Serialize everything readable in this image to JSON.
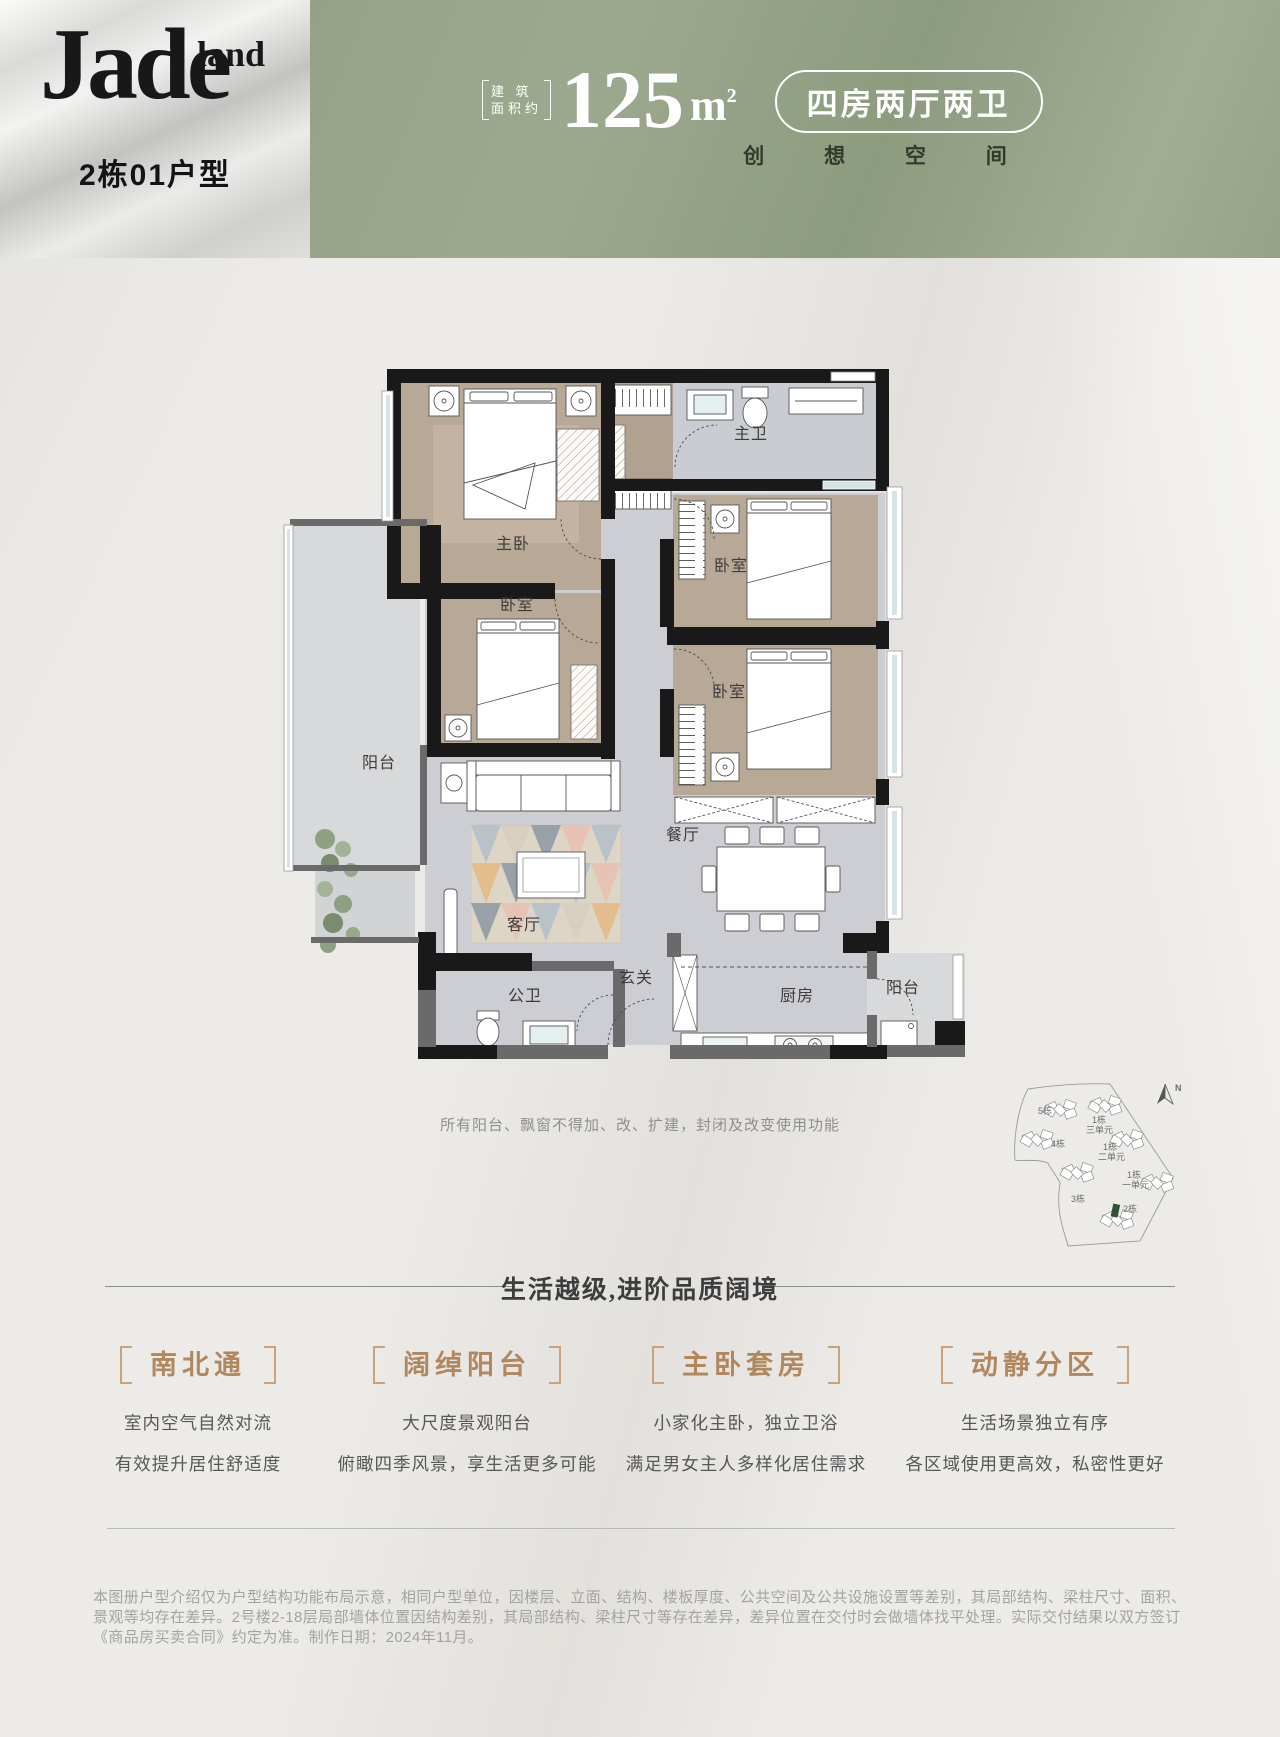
{
  "header": {
    "logo_main": "Jade",
    "logo_sub": "land",
    "unit_type": "2栋01户型",
    "area_prefix_l1": "建 筑",
    "area_prefix_l2": "面积约",
    "area_value": "125",
    "area_unit": "m",
    "area_sup": "2",
    "layout_badge": "四房两厅两卫",
    "tagline": "创 想 空 间"
  },
  "floorplan": {
    "rooms": [
      {
        "label": "主卧"
      },
      {
        "label": "卧室"
      },
      {
        "label": "阳台"
      },
      {
        "label": "客厅"
      },
      {
        "label": "餐厅"
      },
      {
        "label": "主卫"
      },
      {
        "label": "卧室"
      },
      {
        "label": "卧室"
      },
      {
        "label": "玄关"
      },
      {
        "label": "公卫"
      },
      {
        "label": "厨房"
      },
      {
        "label": "阳台"
      }
    ],
    "note": "所有阳台、飘窗不得加、改、扩建，封闭及改变使用功能"
  },
  "siteplan": {
    "north": "N",
    "buildings": [
      {
        "l1": "5栋",
        "l2": ""
      },
      {
        "l1": "1栋",
        "l2": "三单元"
      },
      {
        "l1": "4栋",
        "l2": ""
      },
      {
        "l1": "1栋",
        "l2": "二单元"
      },
      {
        "l1": "3栋",
        "l2": ""
      },
      {
        "l1": "1栋",
        "l2": "一单元"
      },
      {
        "l1": "2栋",
        "l2": ""
      }
    ]
  },
  "section": {
    "heading": "生活越级,进阶品质阔境",
    "features": [
      {
        "title": "南北通",
        "line1": "室内空气自然对流",
        "line2": "有效提升居住舒适度"
      },
      {
        "title": "阔绰阳台",
        "line1": "大尺度景观阳台",
        "line2": "俯瞰四季风景，享生活更多可能"
      },
      {
        "title": "主卧套房",
        "line1": "小家化主卧，独立卫浴",
        "line2": "满足男女主人多样化居住需求"
      },
      {
        "title": "动静分区",
        "line1": "生活场景独立有序",
        "line2": "各区域使用更高效，私密性更好"
      }
    ]
  },
  "disclaimer": "本图册户型介绍仅为户型结构功能布局示意，相同户型单位，因楼层、立面、结构、楼板厚度、公共空间及公共设施设置等差别，其局部结构、梁柱尺寸、面积、景观等均存在差异。2号楼2-18层局部墙体位置因结构差别，其局部结构、梁柱尺寸等存在差异，差异位置在交付时会做墙体找平处理。实际交付结果以双方签订《商品房买卖合同》约定为准。制作日期：2024年11月。",
  "colors": {
    "band_green": "#99a489",
    "accent_bronze": "#b1875e",
    "wall": "#1a1a1a",
    "wood_floor": "#b6a895",
    "tile": "#ccced3",
    "marker_green": "#2e5339"
  }
}
